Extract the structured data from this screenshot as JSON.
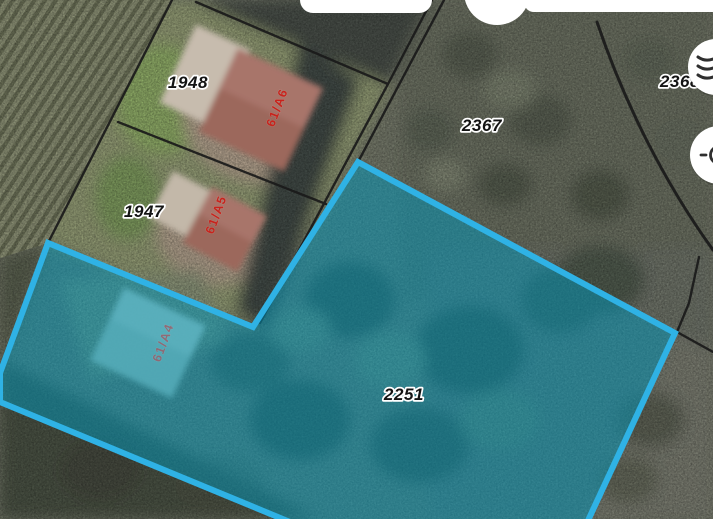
{
  "map": {
    "labels": {
      "parcel_1948": "1948",
      "parcel_1947": "1947",
      "parcel_2367": "2367",
      "parcel_2368": "2368",
      "parcel_2251": "2251",
      "building_61a6": "61/A6",
      "building_61a5": "61/A5",
      "building_61a4": "61/A4"
    },
    "highlight": {
      "parcel": "2251",
      "stroke_color": "#2fb2e5",
      "fill_color": "rgba(0,153,190,0.5)"
    },
    "boundary_color": "#1a1a1a",
    "parcel_label_color": "#141414",
    "building_label_color": "#c8231c",
    "building_label_muted_color": "#a8505a"
  },
  "controls": {
    "layers_button": {
      "icon": "layers-icon"
    },
    "locate_button": {
      "icon": "locate-icon"
    },
    "button_color": "#ffffff",
    "icon_color": "#2f2f2f"
  }
}
